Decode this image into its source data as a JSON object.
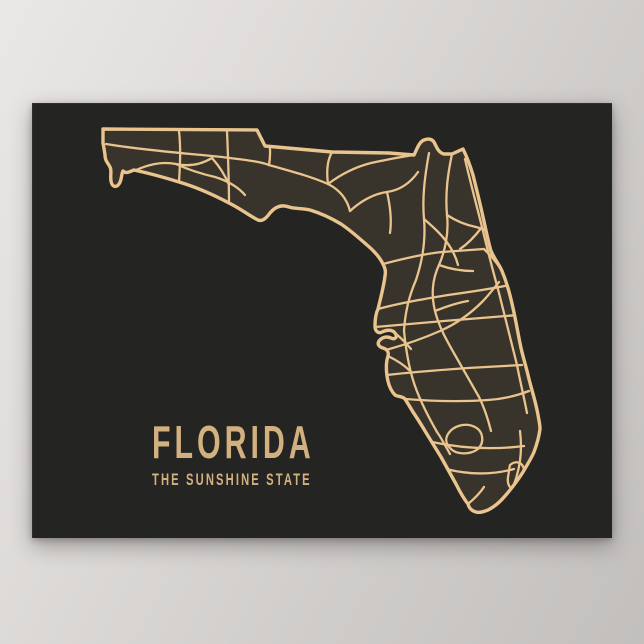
{
  "poster": {
    "title": "FLORIDA",
    "subtitle": "THE SUNSHINE STATE",
    "map_subject": "florida-state-road-map",
    "colors": {
      "wall_top": "#eae8e7",
      "wall_bottom": "#c2bfbd",
      "poster_background": "#242423",
      "map_fill": "#39342b",
      "gold_line": "#e9c48e",
      "gold_text": "#d2b080"
    }
  }
}
